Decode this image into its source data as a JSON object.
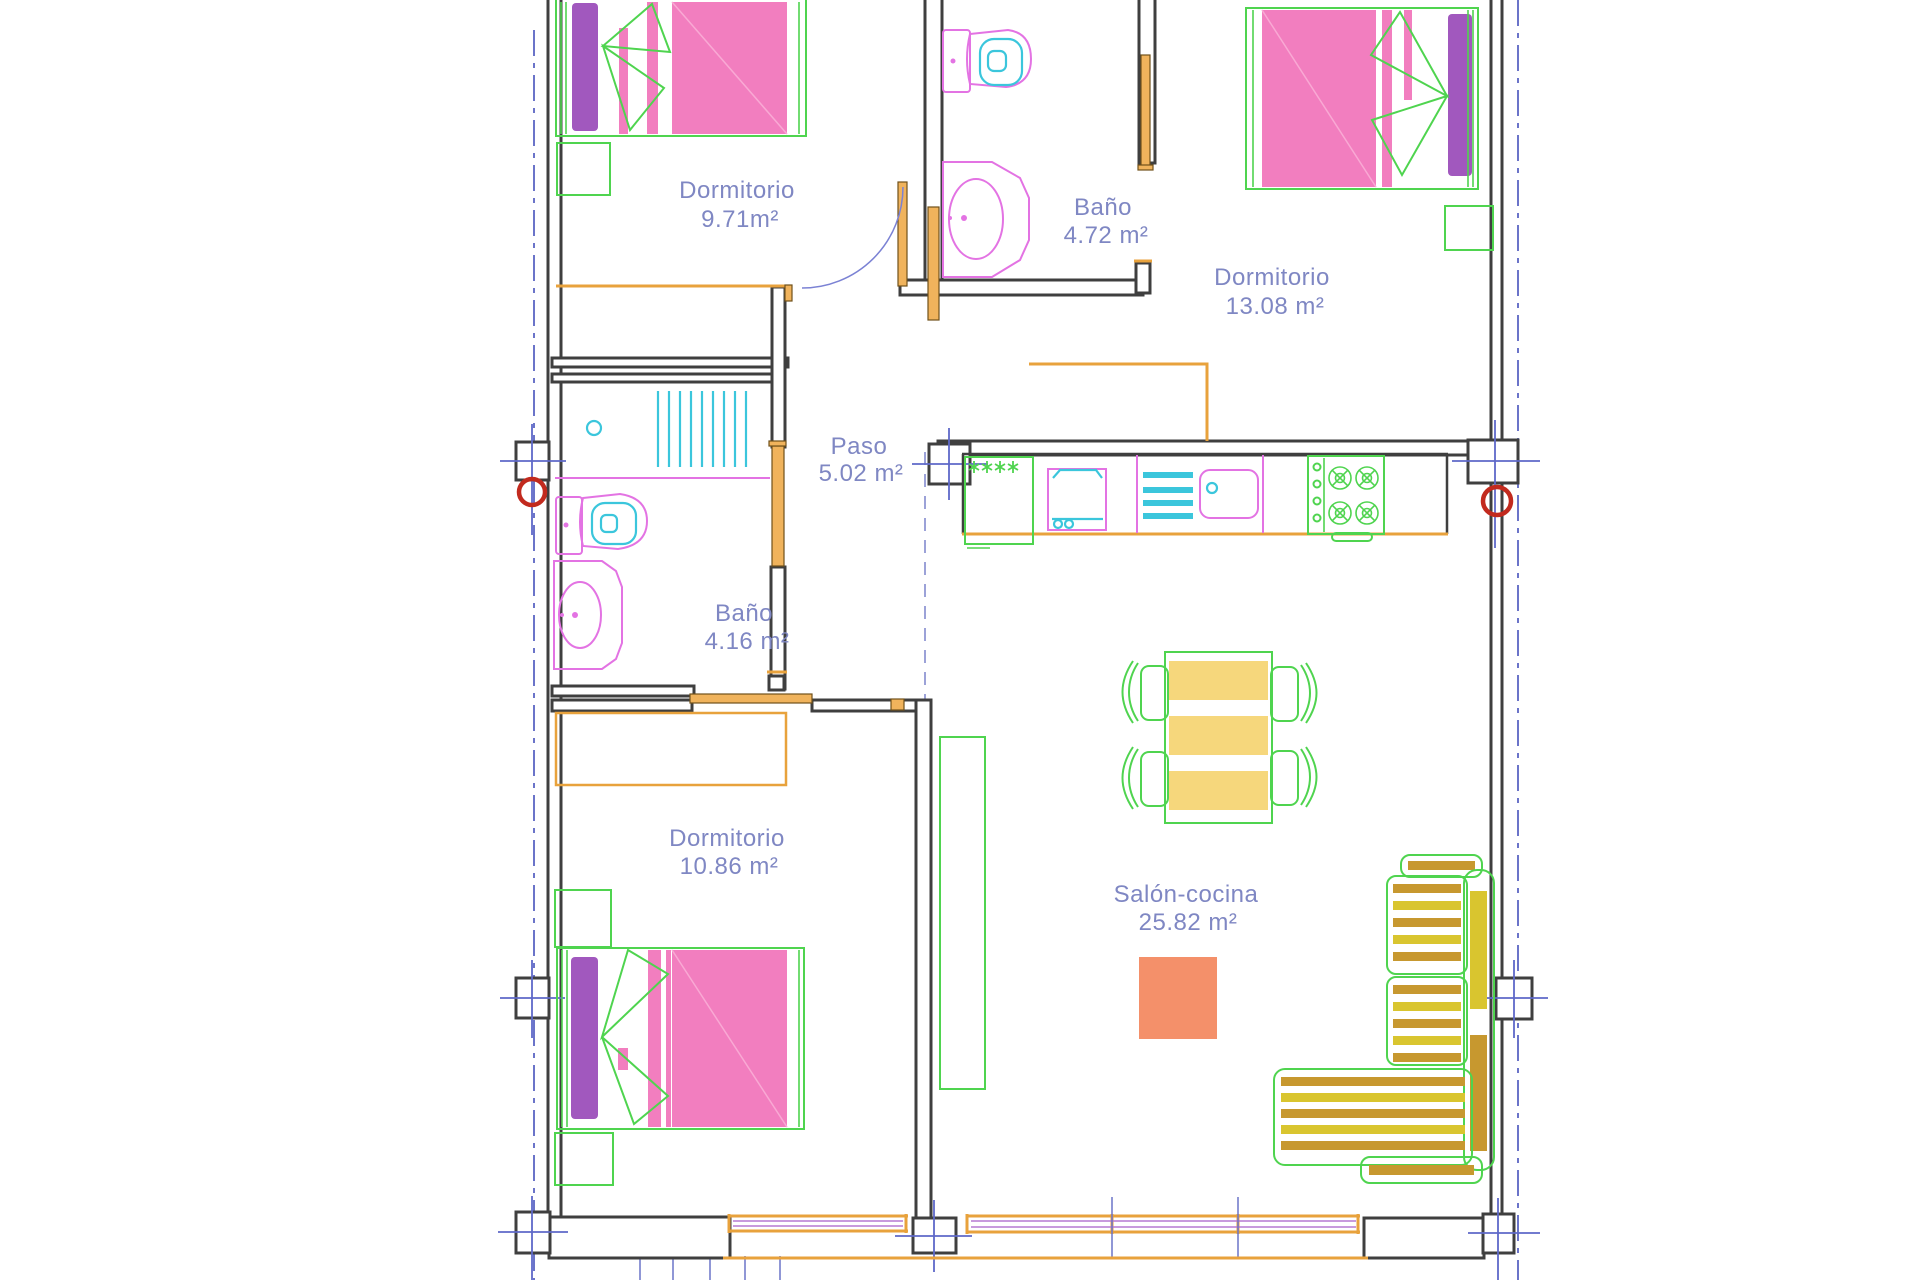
{
  "plan": {
    "rooms": [
      {
        "name": "Dormitorio",
        "area": "9.71m²"
      },
      {
        "name": "Baño",
        "area": "4.72 m²"
      },
      {
        "name": "Dormitorio",
        "area": "13.08 m²"
      },
      {
        "name": "Paso",
        "area": "5.02 m²"
      },
      {
        "name": "Baño",
        "area": "4.16 m²"
      },
      {
        "name": "Dormitorio",
        "area": "10.86 m²"
      },
      {
        "name": "Salón-cocina",
        "area": "25.82 m²"
      }
    ],
    "fixtures": [
      "double-bed",
      "nightstand",
      "wardrobe",
      "toilet",
      "washbasin",
      "shower-tray",
      "refrigerator",
      "washer",
      "dish-drainer",
      "kitchen-sink",
      "gas-cooktop",
      "dining-table",
      "chair",
      "corner-sofa",
      "rug",
      "structural-column",
      "window",
      "door"
    ],
    "colors": {
      "wall": "#3f3f3f",
      "door_orange": "#F0B35C",
      "frame_orange": "#E8A23C",
      "furniture_green": "#4FD44F",
      "bed_pink": "#F27EBF",
      "pillow_purple": "#A158BE",
      "fixture_magenta": "#E373E3",
      "fixture_cyan": "#3BC6DC",
      "axis_blue": "#6B74C9",
      "label_blue": "#7F87C3",
      "column_red": "#C22A1E",
      "table_yellow": "#F6D77C",
      "sofa_gold": "#C7982F",
      "sofa_yellow": "#D9C52F",
      "rug_salmon": "#F4906A"
    }
  }
}
